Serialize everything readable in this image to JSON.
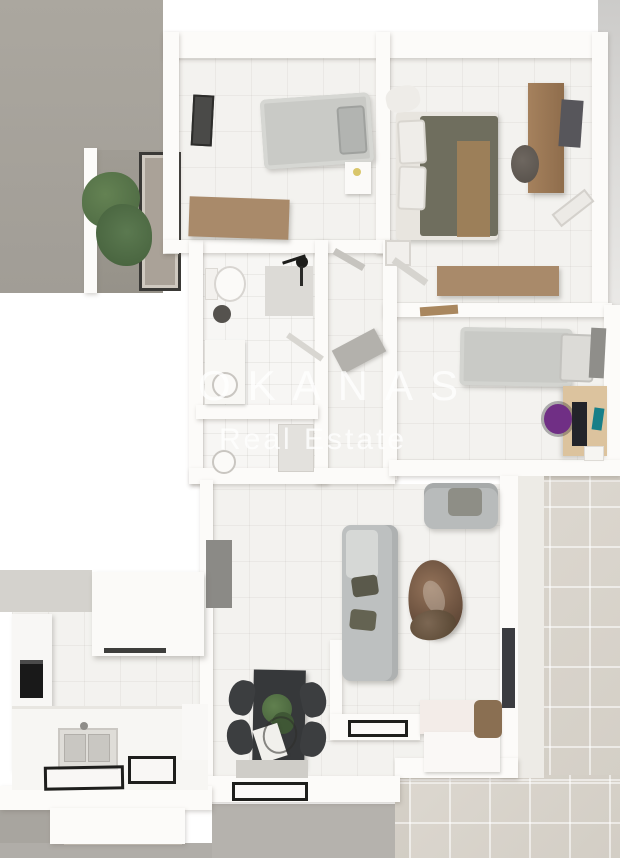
{
  "watermark": {
    "line1": "OKANAS",
    "line2": "Real Estate"
  },
  "palette": {
    "backdrop": "#a8a49d",
    "backdrop_dark": "#b3b0ab",
    "wall": "#fcfbf9",
    "floor": "#f3f2ef",
    "terrace": "#d8d3cb",
    "wood": "#a98a6a",
    "wood_light": "#dcc39e",
    "bed_gray": "#c9cac6",
    "duvet": "#6f6e5e",
    "throw": "#a08059",
    "sofa": "#bdc0c0",
    "marble": "#7c6753",
    "dark": "#2e2f31",
    "plant": "#57744c",
    "accent_purple": "#702f85",
    "accent_teal": "#177f88",
    "watermark": "#ffffff"
  }
}
